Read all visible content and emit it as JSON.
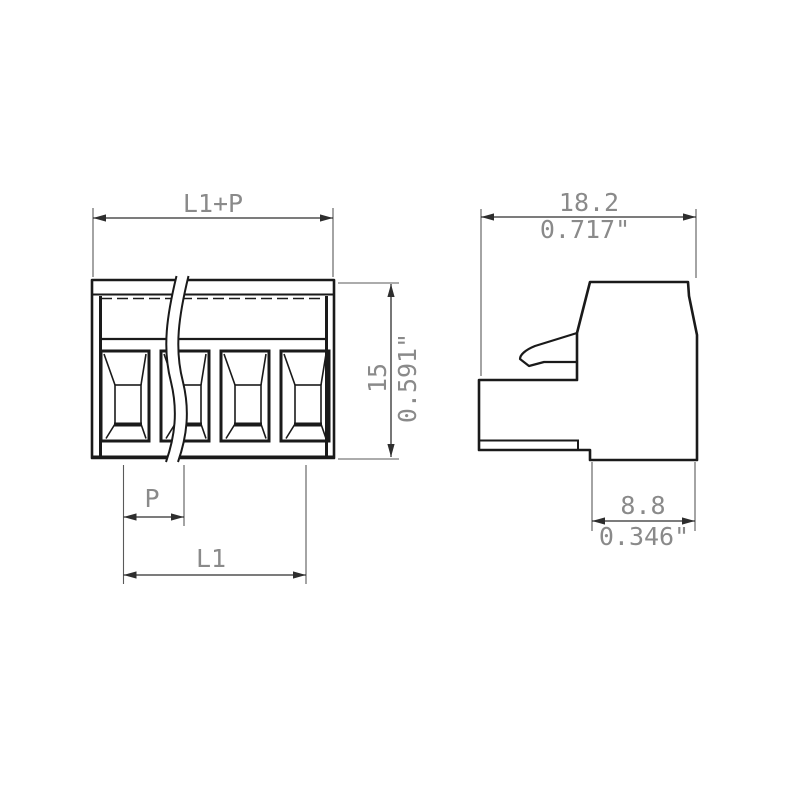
{
  "drawing": {
    "front_view": {
      "pole_count": 4,
      "dim_overall_width_label": "L1+P",
      "dim_height_mm": "15",
      "dim_height_inch": "0.591\"",
      "dim_pitch_label": "P",
      "dim_length_label": "L1"
    },
    "side_view": {
      "dim_width_mm": "18.2",
      "dim_width_inch": "0.717\"",
      "dim_foot_mm": "8.8",
      "dim_foot_inch": "0.346\""
    },
    "colors": {
      "part_line": "#1a1a1a",
      "dimension_line": "#2e2e2e",
      "extension_line": "#5a5a5a",
      "dimension_text": "#8a8a8a",
      "background": "#ffffff"
    }
  }
}
